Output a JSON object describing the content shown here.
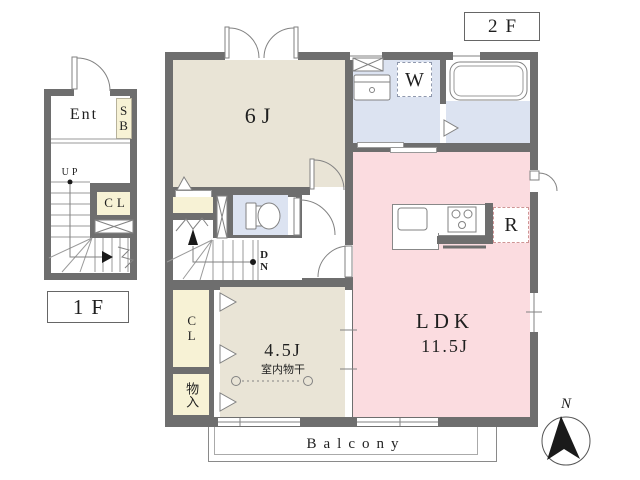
{
  "colors": {
    "wall": "#6e6e6e",
    "room_beige": "#e9e4d6",
    "room_pink": "#fbdce0",
    "room_blue": "#dce3f1",
    "closet_yellow": "#f7f2d5",
    "line": "#828282",
    "text": "#1f1f1f"
  },
  "labels": {
    "floor2_tag": "2F",
    "floor1_tag": "1F",
    "balcony": "Balcony",
    "compass_north": "N"
  },
  "floor1": {
    "entrance": "Ent",
    "shoe_box": "SB",
    "up": "UP",
    "closet": "CL"
  },
  "floor2": {
    "bedroom_size": "6J",
    "washer": "W",
    "refrigerator": "R",
    "ldk_name": "LDK",
    "ldk_size": "11.5J",
    "room45_size": "4.5J",
    "indoor_drying": "室内物干",
    "closet": "CL",
    "storage": "物入",
    "down": "DN"
  }
}
